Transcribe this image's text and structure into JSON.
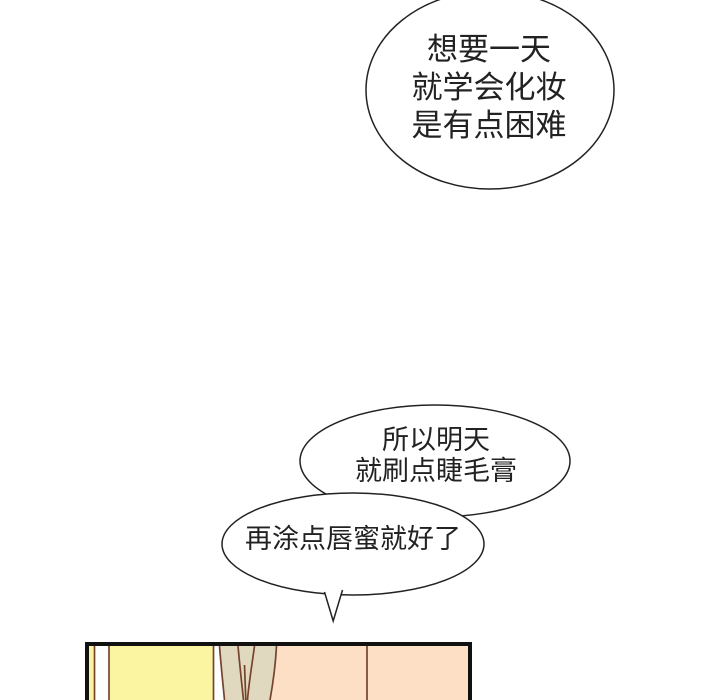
{
  "colors": {
    "ink": "#222222",
    "panel_border": "#111111",
    "outline_brown": "#75432e",
    "wall_yellow": "#fbf5a1",
    "hair_tan": "#e1d9bf",
    "wall_peach": "#fcdfc5",
    "bubble_fill": "#ffffff"
  },
  "bubbles": [
    {
      "name": "top-speech-bubble",
      "lines": [
        "想要一天",
        "就学会化妆",
        "是有点困难"
      ]
    },
    {
      "name": "middle-speech-bubble",
      "lines": [
        "所以明天",
        "就刷点睫毛膏"
      ]
    },
    {
      "name": "bottom-speech-bubble",
      "lines": [
        "再涂点唇蜜就好了"
      ]
    }
  ]
}
